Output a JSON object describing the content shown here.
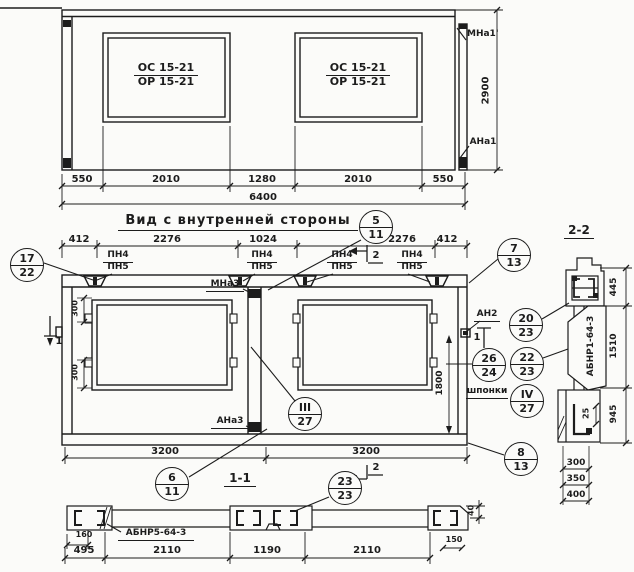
{
  "top_view": {
    "window_label_top": "ОС 15-21",
    "window_label_bottom": "ОР 15-21",
    "dims": [
      "550",
      "2010",
      "1280",
      "2010",
      "550"
    ],
    "total_dim": "6400",
    "height_dim": "2900",
    "mark_top_right": "МНа1'",
    "mark_bottom_right": "АНа1"
  },
  "title": "Вид с внутренней стороны",
  "main_view": {
    "top_dims": [
      "412",
      "2276",
      "1024",
      "2276",
      "412"
    ],
    "pn_top": "ПН4",
    "pn_bottom": "ПН5",
    "mark_mna3": "МНа3",
    "mark_ana3": "АНа3",
    "mark_an2": "АН2",
    "keys_label": "шпонки",
    "dim_300_top": "300",
    "dim_300_bottom": "300",
    "dim_1800": "1800",
    "bottom_dims": [
      "3200",
      "3200"
    ],
    "section_marker_1": "1",
    "section_marker_2": "2"
  },
  "callouts": {
    "c5_11": [
      "5",
      "11"
    ],
    "c17_22": [
      "17",
      "22"
    ],
    "c7_13": [
      "7",
      "13"
    ],
    "c20_23": [
      "20",
      "23"
    ],
    "c26_24": [
      "26",
      "24"
    ],
    "c22_23": [
      "22",
      "23"
    ],
    "c4_27": [
      "IV",
      "27"
    ],
    "c3_27": [
      "III",
      "27"
    ],
    "c6_11": [
      "6",
      "11"
    ],
    "c8_13": [
      "8",
      "13"
    ],
    "c23_23": [
      "23",
      "23"
    ]
  },
  "section_1_1": {
    "title": "1-1",
    "part_label": "АБНР5-64-3",
    "dims": [
      "495",
      "2110",
      "1190",
      "2110"
    ],
    "dim_160": "160",
    "dim_150": "150",
    "dim_40": "40"
  },
  "section_2_2": {
    "title": "2-2",
    "part_label": "АБНР1-64-3",
    "right_dims": [
      "445",
      "1510",
      "945"
    ],
    "dim_25": "25",
    "bottom_dims": [
      "300",
      "350",
      "400"
    ]
  }
}
